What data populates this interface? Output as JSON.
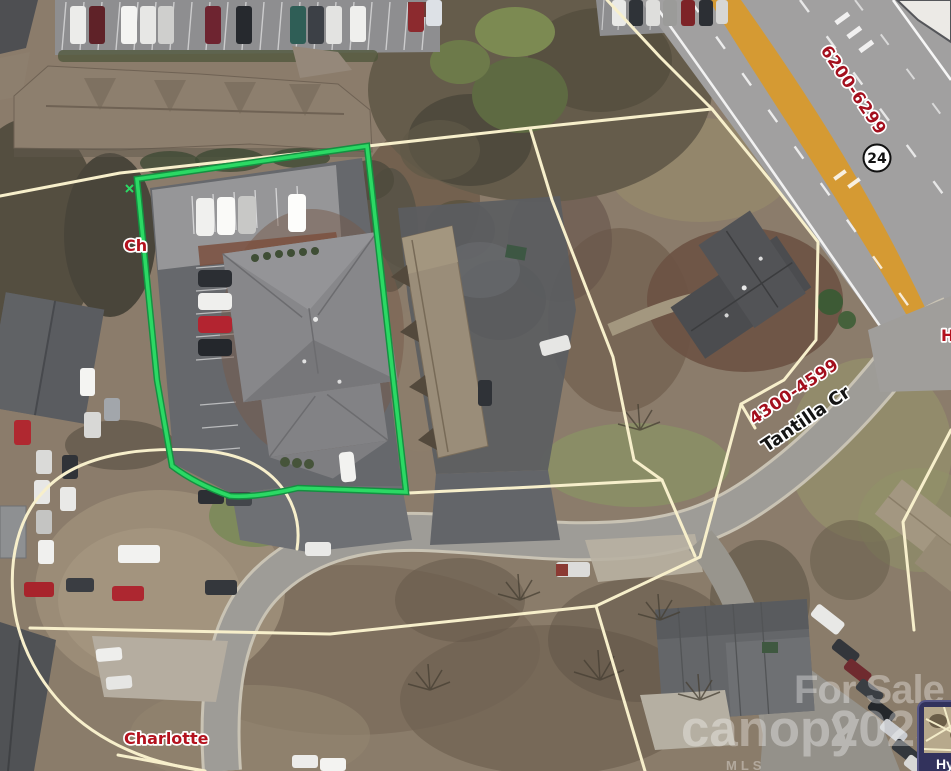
{
  "map": {
    "region_labels": {
      "city_clipped": "Ch",
      "city": "Charlotte",
      "edge_clipped": "H"
    },
    "street_labels": {
      "street_name": "Tantilla Cr",
      "street_range": "4300-4599",
      "highway_range": "6200-6299",
      "highway_shield": "24"
    },
    "watermark": {
      "brand_top": "For Sale",
      "brand": "canopy",
      "year": "2025",
      "mls": "MLS"
    },
    "inset_card": {
      "label_clipped": "Hy"
    },
    "theme": {
      "subject_parcel_color": "#2BD964",
      "parcel_line_color": "#F7EFCB",
      "label_red": "#B3121E",
      "street_label_color": "#141414",
      "highway_median_color": "#D59A33",
      "shield_fill": "#FFFFFF",
      "shield_border": "#111111",
      "watermark_color": "#FFFFFF",
      "inset_background": "#32325C"
    }
  }
}
